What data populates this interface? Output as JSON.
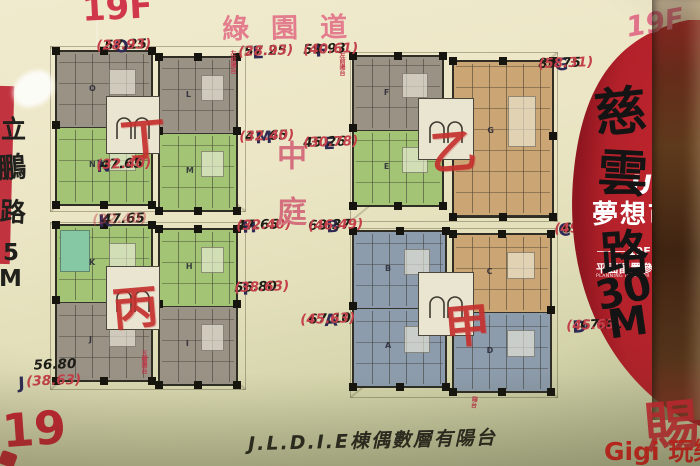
{
  "colors": {
    "gray_unit": "#9b9286",
    "green_unit": "#a3c475",
    "tan_unit": "#cba573",
    "blue_unit": "#8d9cac",
    "teal_unit": "#86c7a4",
    "red_circle": "#b3212a",
    "marker_red": "#c5302e",
    "pink": "#e37d8e"
  },
  "header": {
    "floor_tl": "19F",
    "green_blvd": "綠園道",
    "floor_tr": "19F"
  },
  "left_edge": {
    "chars": [
      "立",
      "鵬",
      "路",
      "5",
      "M"
    ]
  },
  "courtyard": {
    "text": "中庭"
  },
  "buildings": {
    "tl_char": "丁",
    "tr_char": "乙",
    "bl_char": "丙",
    "br_char": "甲"
  },
  "units": {
    "O": {
      "id": "O",
      "area": "57.25",
      "net": "(28.93)"
    },
    "L": {
      "id": "L",
      "area": "57.25",
      "net": "(28.93)",
      "note": "左前陽台"
    },
    "F": {
      "id": "F",
      "area": "59.93",
      "net": "(40.61)",
      "note": "左前陽台"
    },
    "G": {
      "id": "G",
      "area": "85.75",
      "net": "(58.31)"
    },
    "M": {
      "id": "M",
      "area": "47.65",
      "net": "(32.40)"
    },
    "E": {
      "id": "E",
      "area": "45.26",
      "net": "(30.78)"
    },
    "N": {
      "id": "N",
      "area": "47.65",
      "net": "(32.40)"
    },
    "K": {
      "id": "K",
      "area": "47.65",
      "net": "(32.40)"
    },
    "H": {
      "id": "H",
      "area": "47.65",
      "net": "(32.40)"
    },
    "B": {
      "id": "B",
      "area": "68.37",
      "net": "(46.49)"
    },
    "I": {
      "id": "I",
      "area": "56.80",
      "net": "(38.63)"
    },
    "A": {
      "id": "A",
      "area": "67.10",
      "net": "(45.63)"
    },
    "J": {
      "id": "J",
      "area": "56.80",
      "net": "(38.63)"
    },
    "D": {
      "id": "D",
      "area": "67.11",
      "net": "(45.63)"
    },
    "C": {
      "id": "C",
      "area": "67.3",
      "net": "(49"
    }
  },
  "plan_notes": {
    "bl": "五樓陽台",
    "br": "陽台"
  },
  "poster": {
    "brand_top": "Ur",
    "brand": "夢想市",
    "floor": "19F",
    "title": "平面配置參考示意圖",
    "subtitle": "PLANNING INTERIOR GROUND PLAN"
  },
  "handwriting": {
    "ciyun": [
      "慈",
      "雲",
      "路"
    ],
    "width_num": "30",
    "width_unit": "M",
    "bottom_note": "J.L.D.I.E棟偶數層有陽台",
    "floor_bl": "19",
    "right_red": "賜"
  },
  "watermark": {
    "text": "Gigi 玩樂家"
  }
}
